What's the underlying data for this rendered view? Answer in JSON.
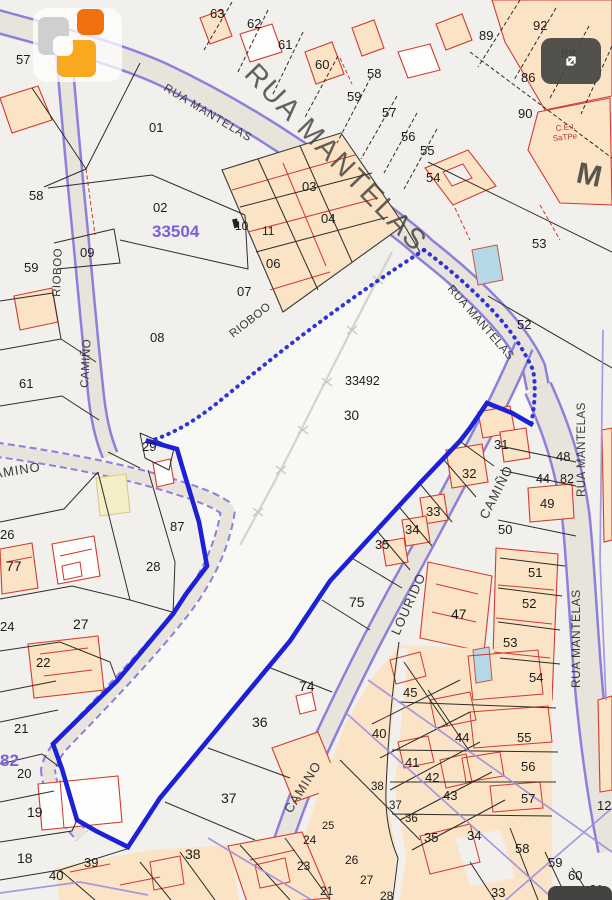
{
  "map": {
    "colors": {
      "selected_boundary": "#1c20d6",
      "road_edge": "#8d80dc",
      "building_outline": "#d23b2f",
      "building_fill": "#fbe3c6",
      "pool_fill": "#b5d8e6",
      "sector_text": "#7a5fd8"
    },
    "sector_reference": "33504",
    "selected_parcel_reference": "33492",
    "selected_parcel_number": "30",
    "parcel_labels": [
      {
        "text": "57",
        "x": 16,
        "y": 64
      },
      {
        "text": "63",
        "x": 210,
        "y": 18
      },
      {
        "text": "62",
        "x": 247,
        "y": 28
      },
      {
        "text": "61",
        "x": 278,
        "y": 49
      },
      {
        "text": "60",
        "x": 315,
        "y": 69
      },
      {
        "text": "58",
        "x": 367,
        "y": 78
      },
      {
        "text": "59",
        "x": 347,
        "y": 101
      },
      {
        "text": "57",
        "x": 382,
        "y": 117
      },
      {
        "text": "56",
        "x": 401,
        "y": 141
      },
      {
        "text": "55",
        "x": 420,
        "y": 155
      },
      {
        "text": "54",
        "x": 426,
        "y": 182
      },
      {
        "text": "89",
        "x": 479,
        "y": 40
      },
      {
        "text": "92",
        "x": 533,
        "y": 30
      },
      {
        "text": "88",
        "x": 561,
        "y": 58
      },
      {
        "text": "86",
        "x": 521,
        "y": 82
      },
      {
        "text": "90",
        "x": 518,
        "y": 118
      },
      {
        "text": "53",
        "x": 532,
        "y": 248
      },
      {
        "text": "52",
        "x": 517,
        "y": 329
      },
      {
        "text": "58",
        "x": 29,
        "y": 200
      },
      {
        "text": "02",
        "x": 153,
        "y": 212
      },
      {
        "text": "33504",
        "x": 152,
        "y": 237,
        "s": 17,
        "c": "#7a5fd8",
        "w": "bold"
      },
      {
        "text": "09",
        "x": 80,
        "y": 257
      },
      {
        "text": "59",
        "x": 24,
        "y": 272
      },
      {
        "text": "01",
        "x": 149,
        "y": 132
      },
      {
        "text": "08",
        "x": 150,
        "y": 342
      },
      {
        "text": "61",
        "x": 19,
        "y": 388
      },
      {
        "text": "03",
        "x": 302,
        "y": 191
      },
      {
        "text": "04",
        "x": 321,
        "y": 223
      },
      {
        "text": "06",
        "x": 266,
        "y": 268
      },
      {
        "text": "07",
        "x": 237,
        "y": 296
      },
      {
        "text": "10",
        "x": 235,
        "y": 230,
        "s": 12
      },
      {
        "text": "11",
        "x": 262,
        "y": 235,
        "s": 12
      },
      {
        "text": "33492",
        "x": 345,
        "y": 385,
        "s": 12.5
      },
      {
        "text": "30",
        "x": 344,
        "y": 420,
        "s": 13.5
      },
      {
        "text": "29",
        "x": 142,
        "y": 451
      },
      {
        "text": "87",
        "x": 170,
        "y": 531
      },
      {
        "text": "28",
        "x": 146,
        "y": 571
      },
      {
        "text": "27",
        "x": 73,
        "y": 629,
        "s": 14
      },
      {
        "text": "26",
        "x": 0,
        "y": 539
      },
      {
        "text": "77",
        "x": 6,
        "y": 571,
        "s": 14
      },
      {
        "text": "24",
        "x": 0,
        "y": 631
      },
      {
        "text": "22",
        "x": 36,
        "y": 667
      },
      {
        "text": "21",
        "x": 14,
        "y": 733
      },
      {
        "text": "82",
        "x": 0,
        "y": 766,
        "s": 17,
        "c": "#7a5fd8",
        "w": "bold"
      },
      {
        "text": "20",
        "x": 17,
        "y": 778
      },
      {
        "text": "19",
        "x": 27,
        "y": 817,
        "s": 14
      },
      {
        "text": "18",
        "x": 17,
        "y": 863,
        "s": 14
      },
      {
        "text": "39",
        "x": 84,
        "y": 867
      },
      {
        "text": "40",
        "x": 49,
        "y": 880
      },
      {
        "text": "31",
        "x": 494,
        "y": 449
      },
      {
        "text": "32",
        "x": 462,
        "y": 478
      },
      {
        "text": "33",
        "x": 426,
        "y": 516
      },
      {
        "text": "34",
        "x": 405,
        "y": 534
      },
      {
        "text": "35",
        "x": 375,
        "y": 549
      },
      {
        "text": "75",
        "x": 349,
        "y": 607,
        "s": 14
      },
      {
        "text": "74",
        "x": 299,
        "y": 691,
        "s": 14
      },
      {
        "text": "36",
        "x": 252,
        "y": 727,
        "s": 14
      },
      {
        "text": "37",
        "x": 221,
        "y": 803,
        "s": 14
      },
      {
        "text": "38",
        "x": 185,
        "y": 859,
        "s": 14
      },
      {
        "text": "48",
        "x": 556,
        "y": 461
      },
      {
        "text": "44",
        "x": 536,
        "y": 483,
        "s": 12.5
      },
      {
        "text": "82",
        "x": 560,
        "y": 483,
        "s": 12.5
      },
      {
        "text": "49",
        "x": 540,
        "y": 508
      },
      {
        "text": "50",
        "x": 498,
        "y": 534
      },
      {
        "text": "47",
        "x": 451,
        "y": 619,
        "s": 14
      },
      {
        "text": "51",
        "x": 528,
        "y": 577
      },
      {
        "text": "52",
        "x": 522,
        "y": 608
      },
      {
        "text": "53",
        "x": 503,
        "y": 647
      },
      {
        "text": "54",
        "x": 529,
        "y": 682
      },
      {
        "text": "55",
        "x": 517,
        "y": 742
      },
      {
        "text": "56",
        "x": 521,
        "y": 771
      },
      {
        "text": "57",
        "x": 521,
        "y": 803
      },
      {
        "text": "58",
        "x": 515,
        "y": 853
      },
      {
        "text": "59",
        "x": 548,
        "y": 867
      },
      {
        "text": "60",
        "x": 568,
        "y": 880
      },
      {
        "text": "61",
        "x": 589,
        "y": 894
      },
      {
        "text": "12",
        "x": 597,
        "y": 810
      },
      {
        "text": "33",
        "x": 491,
        "y": 897
      },
      {
        "text": "45",
        "x": 403,
        "y": 697
      },
      {
        "text": "40",
        "x": 372,
        "y": 738
      },
      {
        "text": "44",
        "x": 455,
        "y": 742
      },
      {
        "text": "41",
        "x": 405,
        "y": 767
      },
      {
        "text": "42",
        "x": 425,
        "y": 782
      },
      {
        "text": "43",
        "x": 443,
        "y": 800
      },
      {
        "text": "38",
        "x": 371,
        "y": 790,
        "s": 11.5
      },
      {
        "text": "37",
        "x": 389,
        "y": 809,
        "s": 11.5
      },
      {
        "text": "36",
        "x": 405,
        "y": 822,
        "s": 11.5
      },
      {
        "text": "35",
        "x": 424,
        "y": 842
      },
      {
        "text": "34",
        "x": 467,
        "y": 840
      },
      {
        "text": "25",
        "x": 322,
        "y": 829,
        "s": 11
      },
      {
        "text": "24",
        "x": 303,
        "y": 844,
        "s": 12
      },
      {
        "text": "26",
        "x": 345,
        "y": 864,
        "s": 12
      },
      {
        "text": "23",
        "x": 297,
        "y": 870,
        "s": 12
      },
      {
        "text": "27",
        "x": 360,
        "y": 884,
        "s": 12
      },
      {
        "text": "21",
        "x": 320,
        "y": 895,
        "s": 12
      },
      {
        "text": "28",
        "x": 380,
        "y": 900,
        "s": 12
      }
    ],
    "street_labels": [
      {
        "text": "RUA MANTELAS",
        "x": 163,
        "y": 90,
        "rot": 31,
        "s": 11.5,
        "ls": 1
      },
      {
        "text": "RUA MANTELAS",
        "x": 243,
        "y": 75,
        "rot": 46,
        "s": 29,
        "ls": 2,
        "c": "#3e3e39",
        "o": 0.8
      },
      {
        "text": "RUA MANTELAS",
        "x": 447,
        "y": 289,
        "rot": 49,
        "s": 11.5,
        "ls": 0.5
      },
      {
        "text": "RUA MANTELAS",
        "x": 585,
        "y": 497,
        "rot": -90,
        "s": 11.5,
        "ls": 0.5
      },
      {
        "text": "RUA MANTELAS",
        "x": 580,
        "y": 688,
        "rot": -90,
        "s": 12,
        "ls": 0.5
      },
      {
        "text": "CAMIÑO",
        "x": 88,
        "y": 388,
        "rot": -87,
        "s": 11.5,
        "ls": 0.5
      },
      {
        "text": "RIOBOO",
        "x": 60,
        "y": 297,
        "rot": -88,
        "s": 11.5,
        "ls": 0.5
      },
      {
        "text": "RIOBOO",
        "x": 233,
        "y": 338,
        "rot": -38,
        "s": 11.5,
        "ls": 0.5
      },
      {
        "text": "CAMINO",
        "x": -16,
        "y": 480,
        "rot": -9,
        "s": 13,
        "ls": 1
      },
      {
        "text": "CAMIÑO",
        "x": 487,
        "y": 520,
        "rot": -63,
        "s": 13,
        "ls": 1
      },
      {
        "text": "LOURIDO",
        "x": 399,
        "y": 636,
        "rot": -66,
        "s": 13,
        "ls": 1
      },
      {
        "text": "CAMINO",
        "x": 291,
        "y": 814,
        "rot": -58,
        "s": 13,
        "ls": 1
      },
      {
        "text": "M",
        "x": 575,
        "y": 182,
        "rot": 12,
        "s": 30,
        "w": "bold",
        "c": "#3e3e39",
        "o": 0.85
      }
    ],
    "misc_labels": [
      {
        "text": "C.E.I.",
        "x": 556,
        "y": 131,
        "rot": -6,
        "s": 8,
        "c": "#c23328"
      },
      {
        "text": "SaTPe",
        "x": 553,
        "y": 141,
        "rot": -6,
        "s": 8,
        "c": "#c23328"
      }
    ],
    "icons": {
      "fullscreen": "expand-arrows-icon",
      "logo": "brand-squares-logo"
    }
  }
}
